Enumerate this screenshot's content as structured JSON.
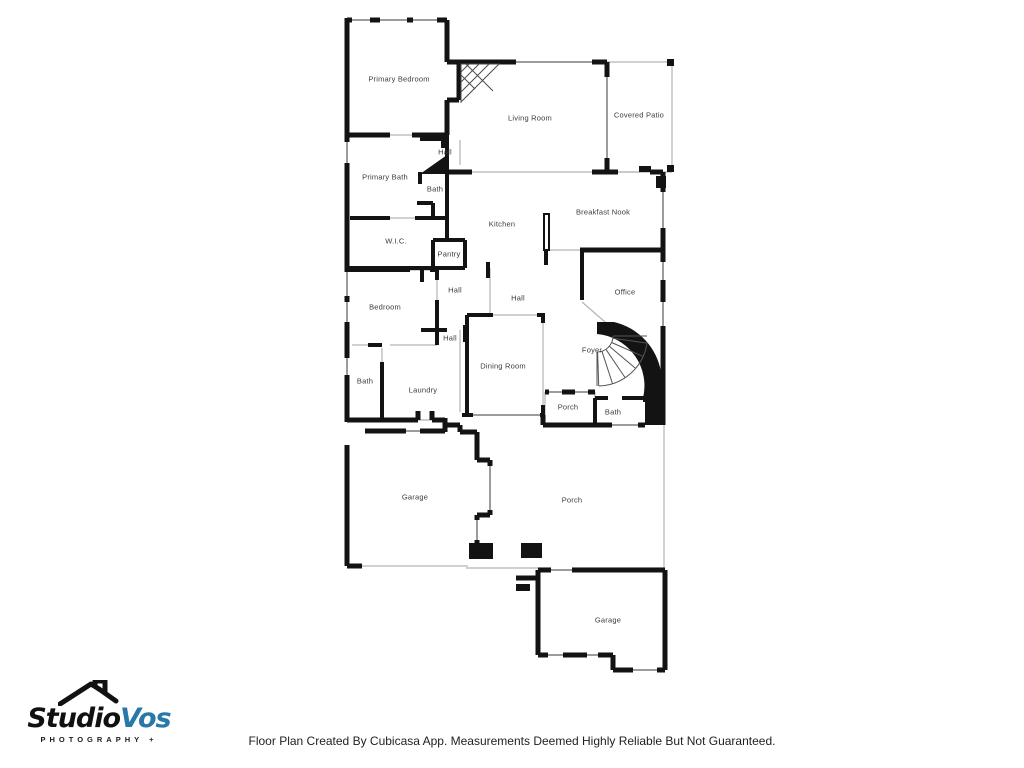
{
  "floor_plan": {
    "rooms": [
      {
        "label": "Primary Bedroom"
      },
      {
        "label": "Living Room"
      },
      {
        "label": "Covered Patio"
      },
      {
        "label": "Hall"
      },
      {
        "label": "Primary Bath"
      },
      {
        "label": "Bath"
      },
      {
        "label": "Kitchen"
      },
      {
        "label": "Breakfast Nook"
      },
      {
        "label": "W.I.C."
      },
      {
        "label": "Pantry"
      },
      {
        "label": "Bedroom"
      },
      {
        "label": "Hall"
      },
      {
        "label": "Hall"
      },
      {
        "label": "Office"
      },
      {
        "label": "Hall"
      },
      {
        "label": "Dining Room"
      },
      {
        "label": "Foyer"
      },
      {
        "label": "Bath"
      },
      {
        "label": "Laundry"
      },
      {
        "label": "Porch"
      },
      {
        "label": "Bath"
      },
      {
        "label": "Garage"
      },
      {
        "label": "Porch"
      },
      {
        "label": "Garage"
      }
    ]
  },
  "logo": {
    "studio": "Studio",
    "vos": "Vos",
    "subtitle": "PHOTOGRAPHY +"
  },
  "footer": {
    "disclaimer": "Floor Plan Created By Cubicasa App. Measurements Deemed Highly Reliable But Not Guaranteed."
  },
  "colors": {
    "wall": "#131313",
    "window_line": "#9c9c9c",
    "thin_line": "#b5b5b5",
    "label_text": "#3b3b3b",
    "logo_blue": "#2878a8",
    "footer_text": "#1f1f1f"
  }
}
